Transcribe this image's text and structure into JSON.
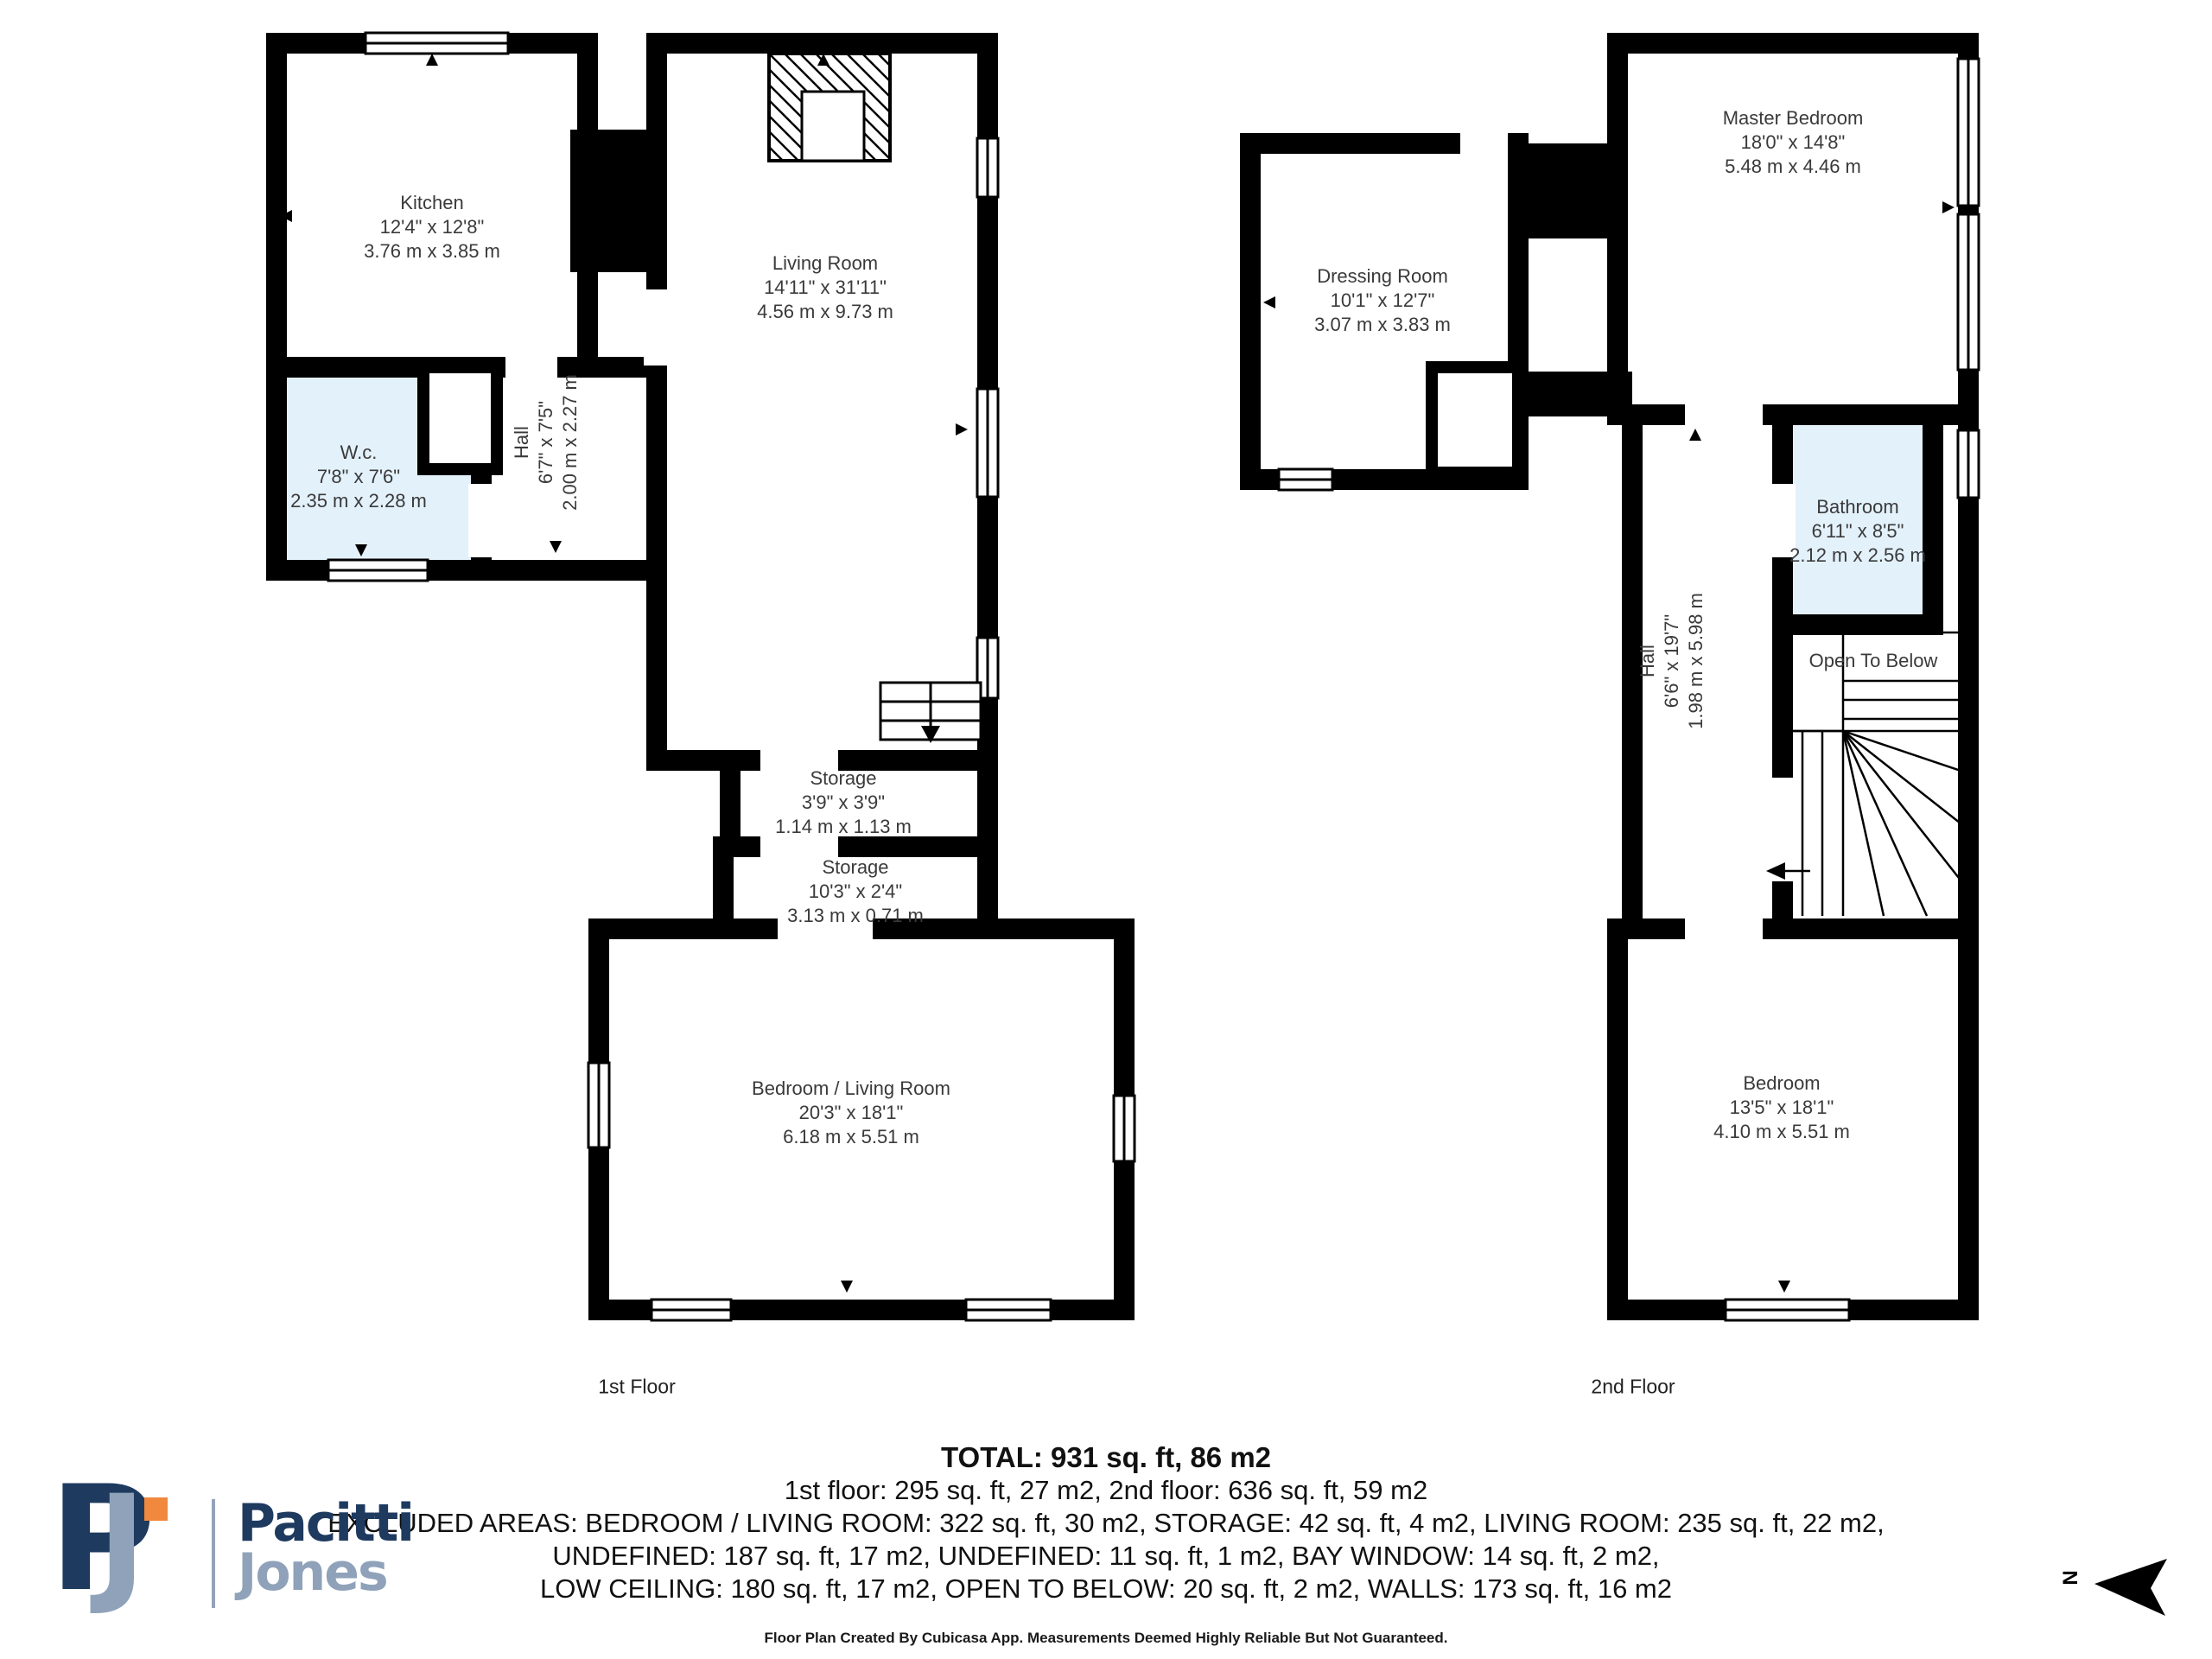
{
  "floors": {
    "first": {
      "label": "1st Floor",
      "rooms": {
        "kitchen": {
          "name": "Kitchen",
          "imperial": "12'4\" x 12'8\"",
          "metric": "3.76 m x 3.85 m"
        },
        "living_room": {
          "name": "Living Room",
          "imperial": "14'11\" x 31'11\"",
          "metric": "4.56 m x 9.73 m"
        },
        "wc": {
          "name": "W.c.",
          "imperial": "7'8\" x 7'6\"",
          "metric": "2.35 m x 2.28 m"
        },
        "hall": {
          "name": "Hall",
          "imperial": "6'7\" x 7'5\"",
          "metric": "2.00 m x 2.27 m"
        },
        "storage_1": {
          "name": "Storage",
          "imperial": "3'9\" x 3'9\"",
          "metric": "1.14 m x 1.13 m"
        },
        "storage_2": {
          "name": "Storage",
          "imperial": "10'3\" x 2'4\"",
          "metric": "3.13 m x 0.71 m"
        },
        "bedroom_living_room": {
          "name": "Bedroom / Living Room",
          "imperial": "20'3\" x 18'1\"",
          "metric": "6.18 m x 5.51 m"
        }
      }
    },
    "second": {
      "label": "2nd Floor",
      "rooms": {
        "master_bedroom": {
          "name": "Master Bedroom",
          "imperial": "18'0\" x 14'8\"",
          "metric": "5.48 m x 4.46 m"
        },
        "dressing_room": {
          "name": "Dressing Room",
          "imperial": "10'1\" x 12'7\"",
          "metric": "3.07 m x 3.83 m"
        },
        "bathroom": {
          "name": "Bathroom",
          "imperial": "6'11\" x 8'5\"",
          "metric": "2.12 m x 2.56 m"
        },
        "hall": {
          "name": "Hall",
          "imperial": "6'6\" x 19'7\"",
          "metric": "1.98 m x 5.98 m"
        },
        "open_to_below": {
          "name": "Open To Below"
        },
        "bedroom": {
          "name": "Bedroom",
          "imperial": "13'5\" x 18'1\"",
          "metric": "4.10 m x 5.51 m"
        }
      }
    }
  },
  "summary": {
    "total": "TOTAL: 931 sq. ft, 86 m2",
    "floors_line": "1st floor: 295 sq. ft, 27 m2, 2nd floor: 636 sq. ft, 59 m2",
    "excluded_line_1": "EXCLUDED AREAS: BEDROOM / LIVING ROOM: 322 sq. ft, 30 m2, STORAGE: 42 sq. ft, 4 m2, LIVING ROOM: 235 sq. ft, 22 m2,",
    "excluded_line_2": "UNDEFINED: 187 sq. ft, 17 m2, UNDEFINED: 11 sq. ft, 1 m2, BAY WINDOW: 14 sq. ft, 2 m2,",
    "excluded_line_3": "LOW CEILING: 180 sq. ft, 17 m2, OPEN TO BELOW: 20 sq. ft, 2 m2, WALLS: 173 sq. ft, 16 m2"
  },
  "footer_note": "Floor Plan Created By Cubicasa App. Measurements Deemed Highly Reliable But Not Guaranteed.",
  "branding": {
    "monogram": {
      "p": "P",
      "j": "J"
    },
    "wordmark": {
      "line1": "Pacitti",
      "line2": "Jones"
    }
  },
  "compass": {
    "label": "N"
  },
  "colors": {
    "walls": "#000000",
    "highlight_room_fill": "#e3f1fb",
    "brand_navy": "#1e3a5f",
    "brand_slate": "#8fa2ba",
    "brand_orange": "#f0883e"
  }
}
